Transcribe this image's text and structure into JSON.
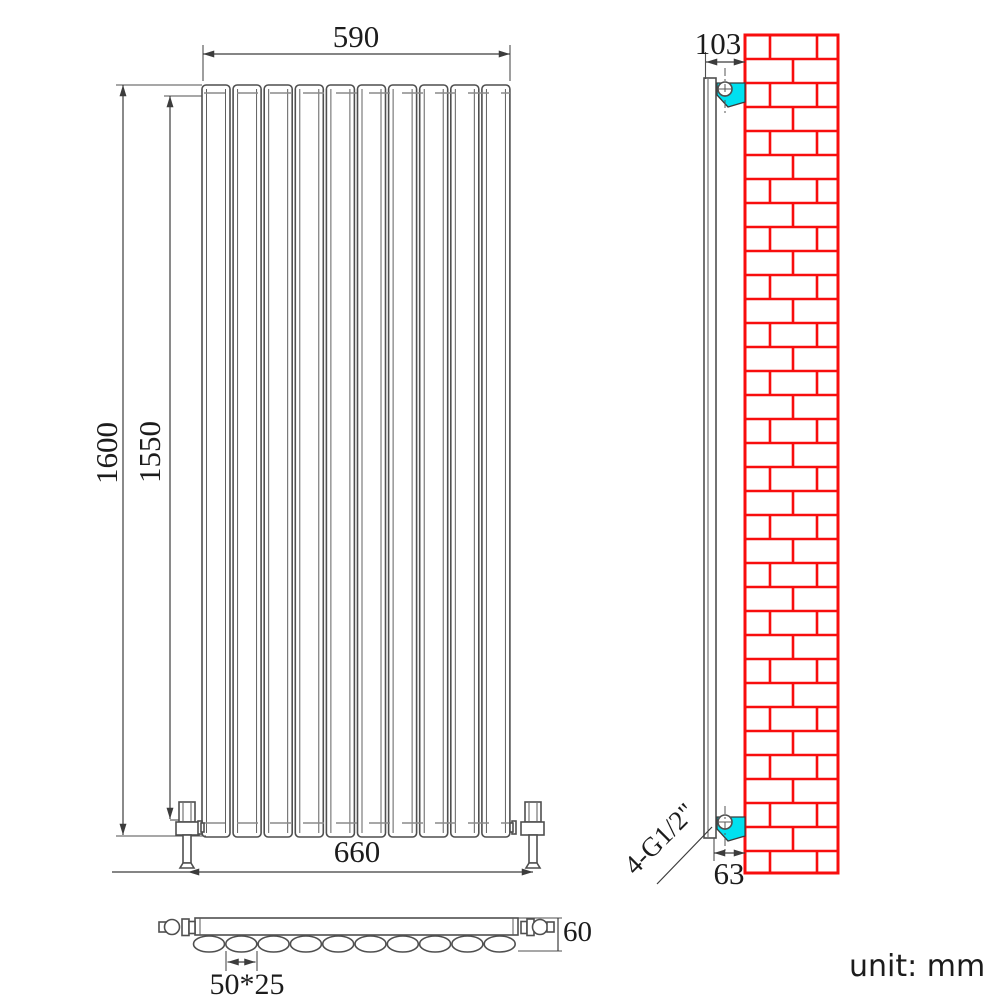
{
  "title": "radiator-technical-drawing",
  "unit_label": "unit: mm",
  "colors": {
    "line": "#4f4f4f",
    "dim": "#3c3c3c",
    "text": "#1c1c1c",
    "brick_red": "#f80d0d",
    "bracket_cyan": "#00e1f0",
    "dash_gray": "#8a8a8a"
  },
  "front_view": {
    "panel_count": 10,
    "dim_width_top": "590",
    "dim_width_bottom": "660",
    "dim_height_outer": "1600",
    "dim_height_inner": "1550"
  },
  "side_view": {
    "dim_wall_offset_top": "103",
    "dim_wall_offset_bottom": "63",
    "connection_label": "4-G1/2\""
  },
  "bottom_view": {
    "oval_count": 10,
    "dim_depth": "60",
    "dim_tube_size": "50*25"
  }
}
